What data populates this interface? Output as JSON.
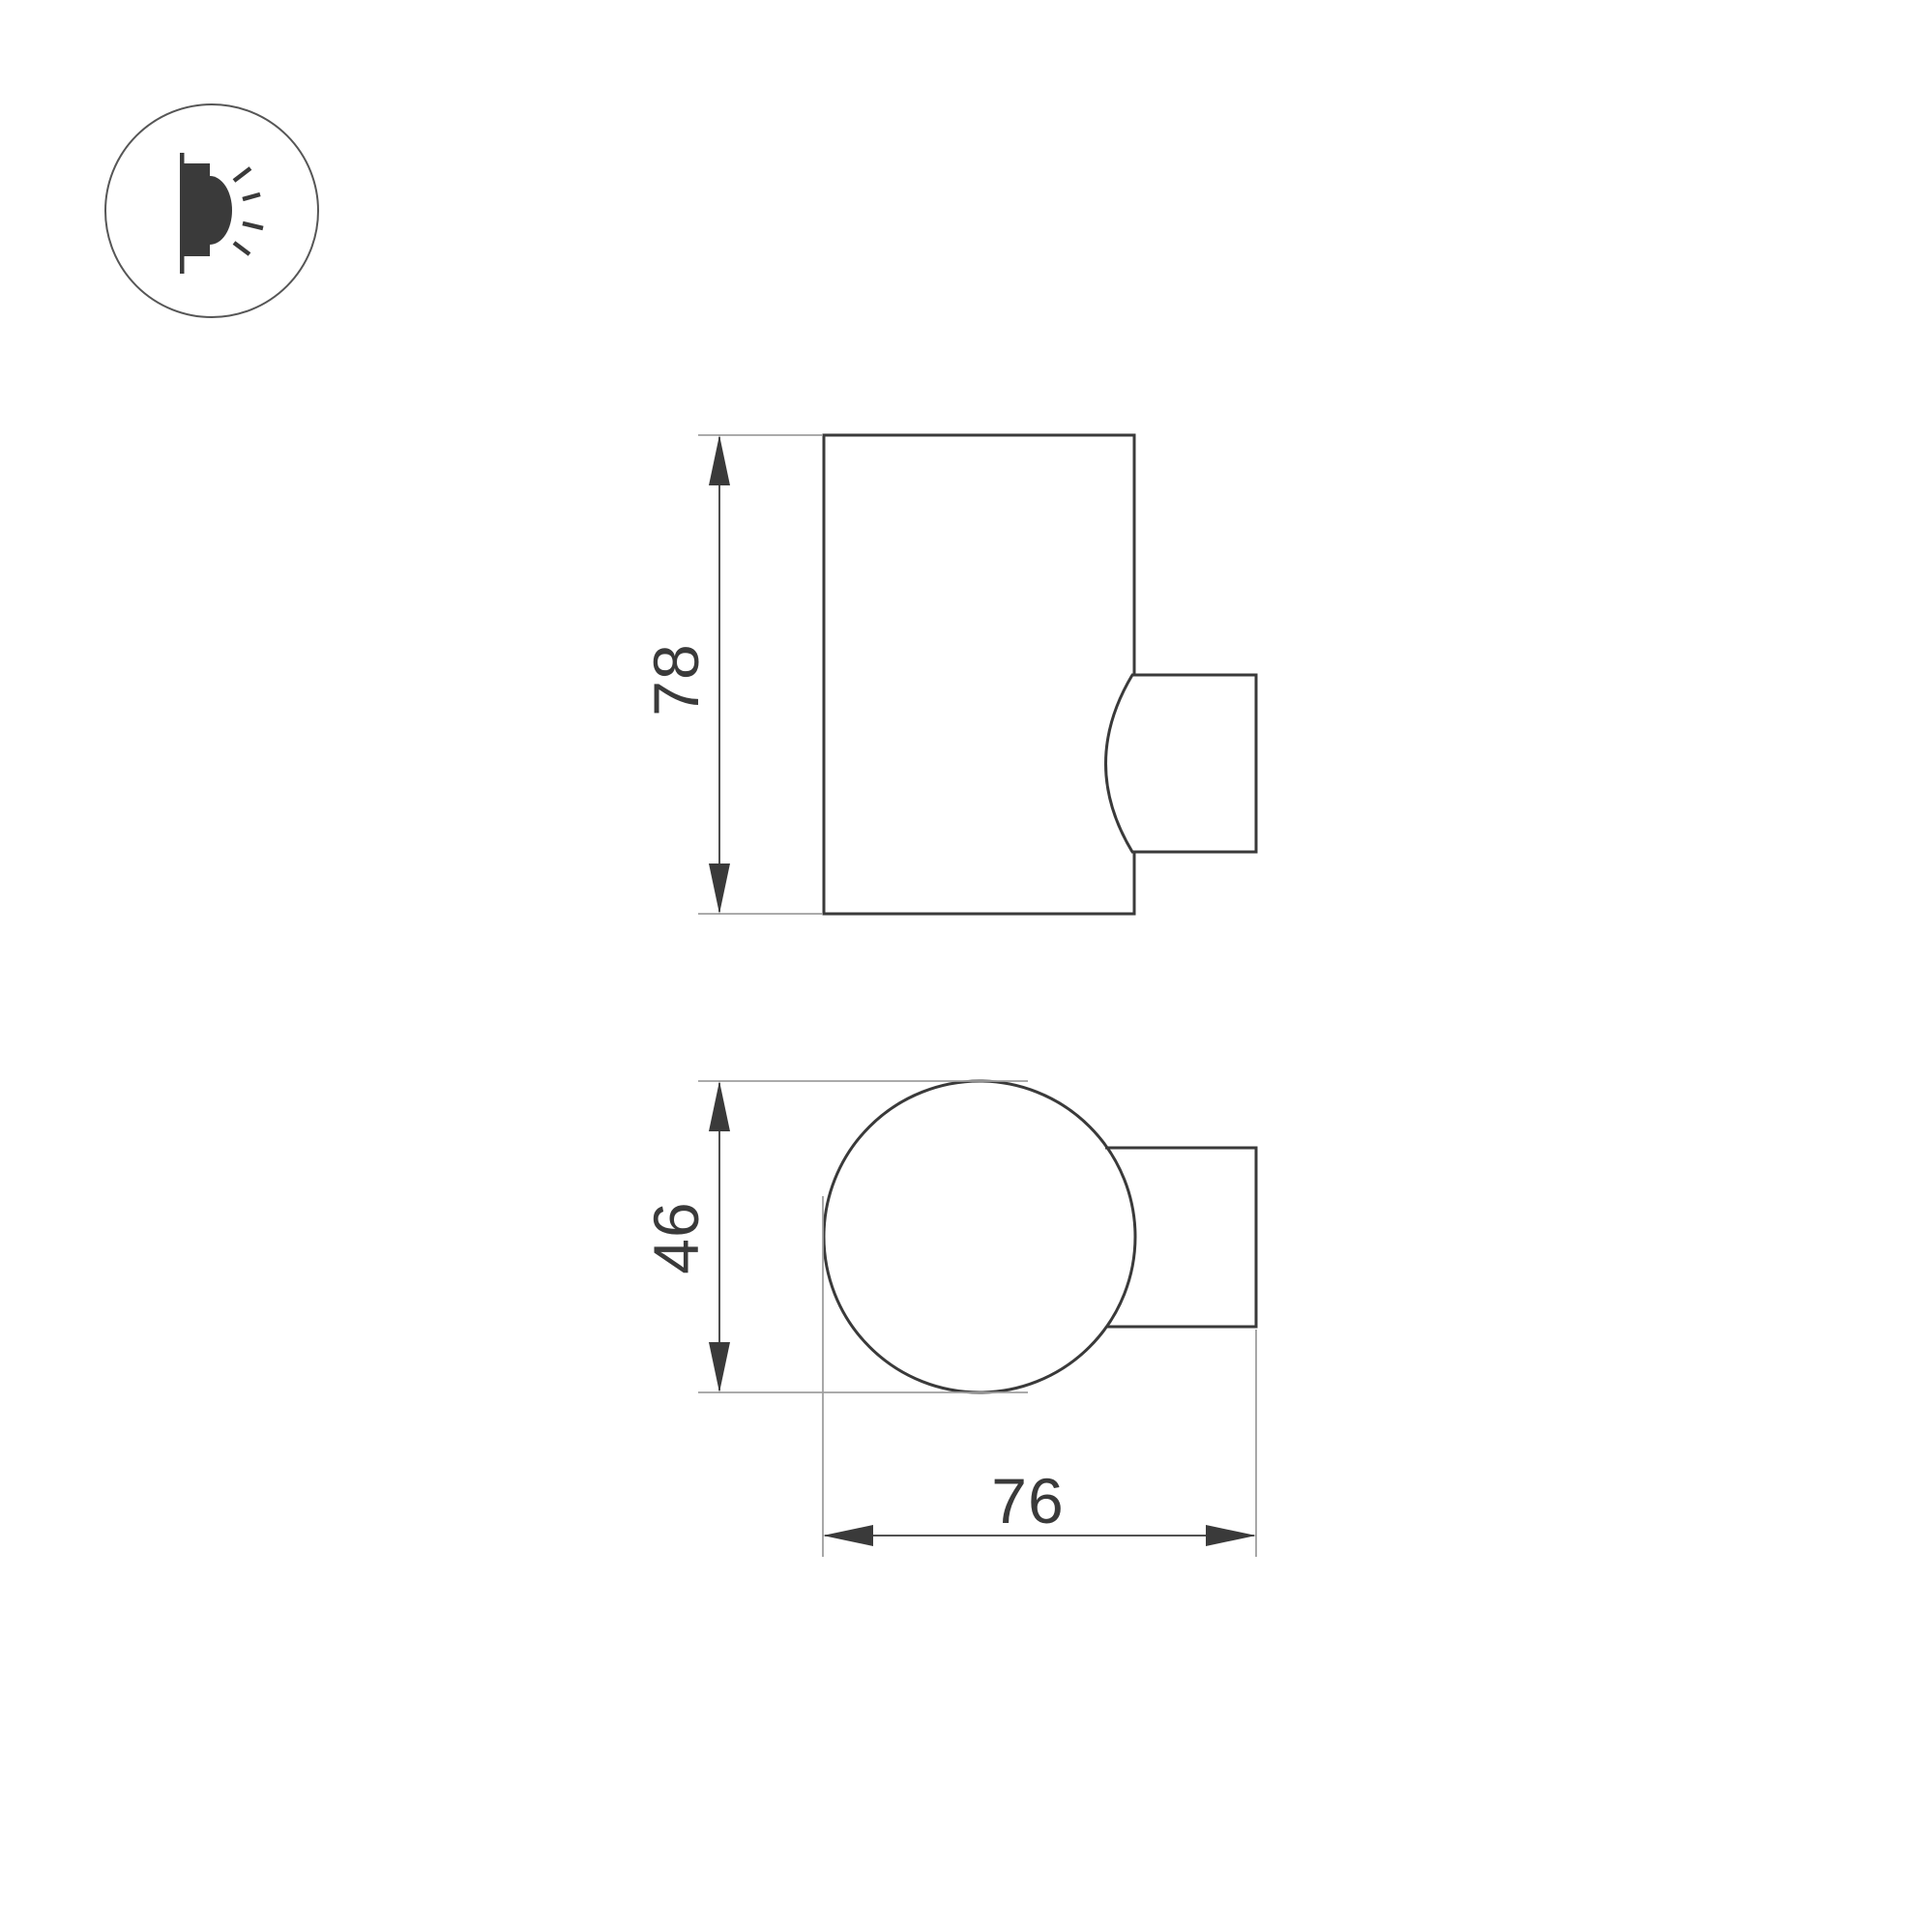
{
  "colors": {
    "background": "#ffffff",
    "line": "#3a3a3a",
    "extension": "#9f9f9f",
    "icon_stroke": "#565656",
    "icon_fill": "#3a3a3a"
  },
  "icons": {
    "product_badge": "wall-lamp-side-emitting-light-icon"
  },
  "views": {
    "side_view": {
      "height_label": "78"
    },
    "top_view": {
      "diameter_label": "46",
      "depth_label": "76"
    }
  }
}
